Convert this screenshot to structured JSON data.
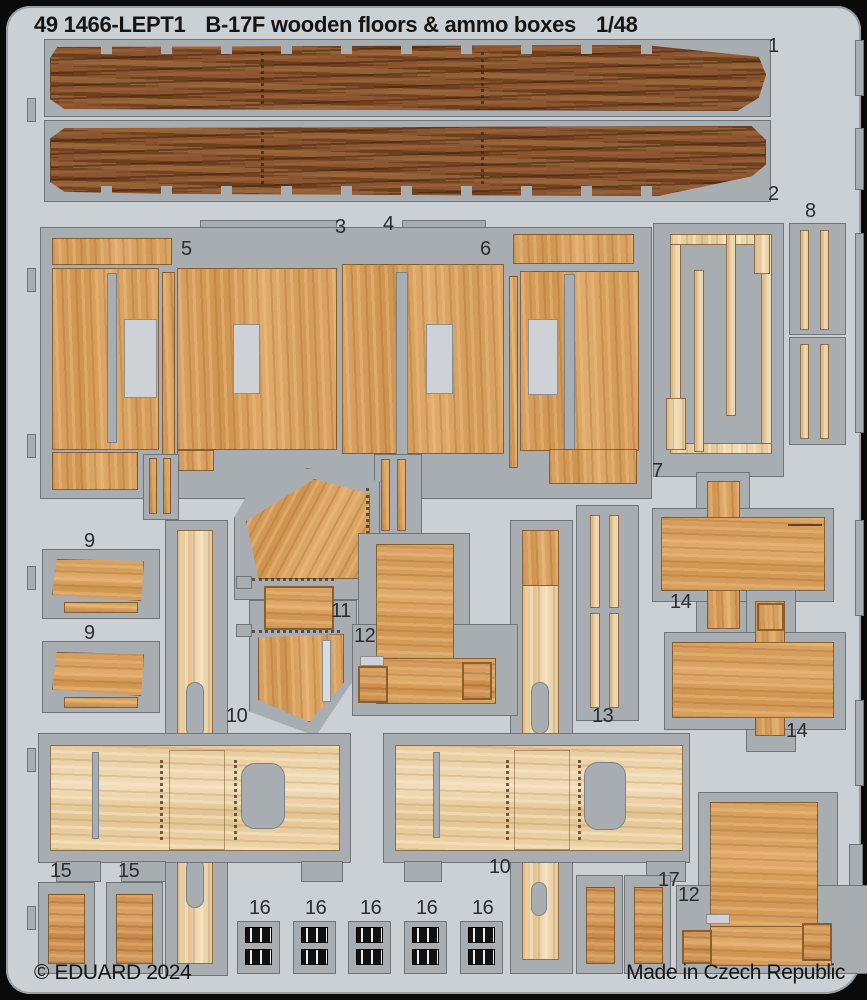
{
  "header": {
    "catalog": "49 1466-LEPT1",
    "product": "B-17F wooden floors & ammo boxes",
    "scale": "1/48"
  },
  "footer": {
    "copyright": "© EDUARD 2024",
    "made_in": "Made in Czech Republic"
  },
  "part_labels": [
    {
      "text": "1"
    },
    {
      "text": "2"
    },
    {
      "text": "3"
    },
    {
      "text": "4"
    },
    {
      "text": "5"
    },
    {
      "text": "6"
    },
    {
      "text": "7"
    },
    {
      "text": "8"
    },
    {
      "text": "9"
    },
    {
      "text": "9"
    },
    {
      "text": "10"
    },
    {
      "text": "11"
    },
    {
      "text": "12"
    },
    {
      "text": "13"
    },
    {
      "text": "14"
    },
    {
      "text": "14"
    },
    {
      "text": "10"
    },
    {
      "text": "15"
    },
    {
      "text": "15"
    },
    {
      "text": "16"
    },
    {
      "text": "16"
    },
    {
      "text": "16"
    },
    {
      "text": "16"
    },
    {
      "text": "16"
    },
    {
      "text": "17"
    },
    {
      "text": "12"
    }
  ],
  "colors": {
    "frame_black": "#0a0a0a",
    "plate_gray": "#cbd0d4",
    "fret_gray": "#a8adb2",
    "wood_dark_brown": "#8a5530",
    "wood_tan": "#d9a263",
    "wood_pale": "#edd4aa",
    "wood_orange": "#d2985c",
    "ammo_belt_olive": "#8f8a45",
    "buckle_black": "#1a1a1a"
  }
}
